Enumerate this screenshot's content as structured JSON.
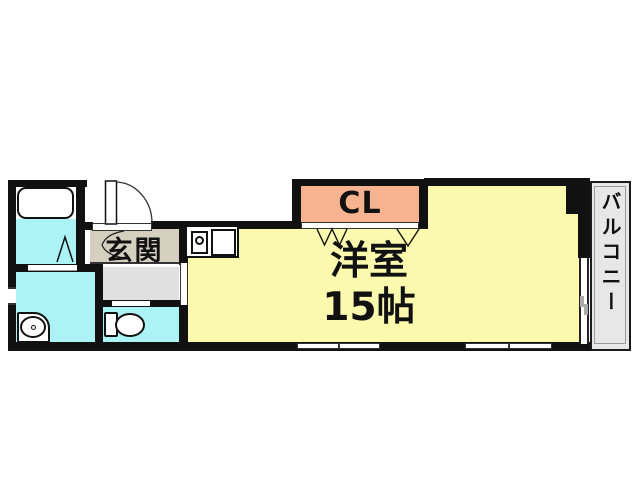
{
  "title": "apartment-floor-plan",
  "labels": {
    "main_room": "洋室",
    "main_room_size": "15帖",
    "closet": "CL",
    "entrance": "玄関",
    "balcony": "バルコニー"
  },
  "colors": {
    "wall": "#111111",
    "main_room": "#fbf9ae",
    "closet": "#f7b28f",
    "entrance": "#d5cfbf",
    "hallway": "#e0e0e0",
    "wet_area": "#abf3f5",
    "balcony": "#e7e7e7",
    "background": "#ffffff"
  },
  "fixtures": {
    "bathtub": "bathtub-icon",
    "toilet": "toilet-icon",
    "washbasin": "washbasin-icon",
    "kitchen_counter": "kitchen-sink-icon",
    "entrance_door": "door-swing-icon",
    "bathroom_door": "folding-door-icon",
    "closet_door": "closet-door-zigzag-icon",
    "windows": "sliding-window-icon"
  }
}
